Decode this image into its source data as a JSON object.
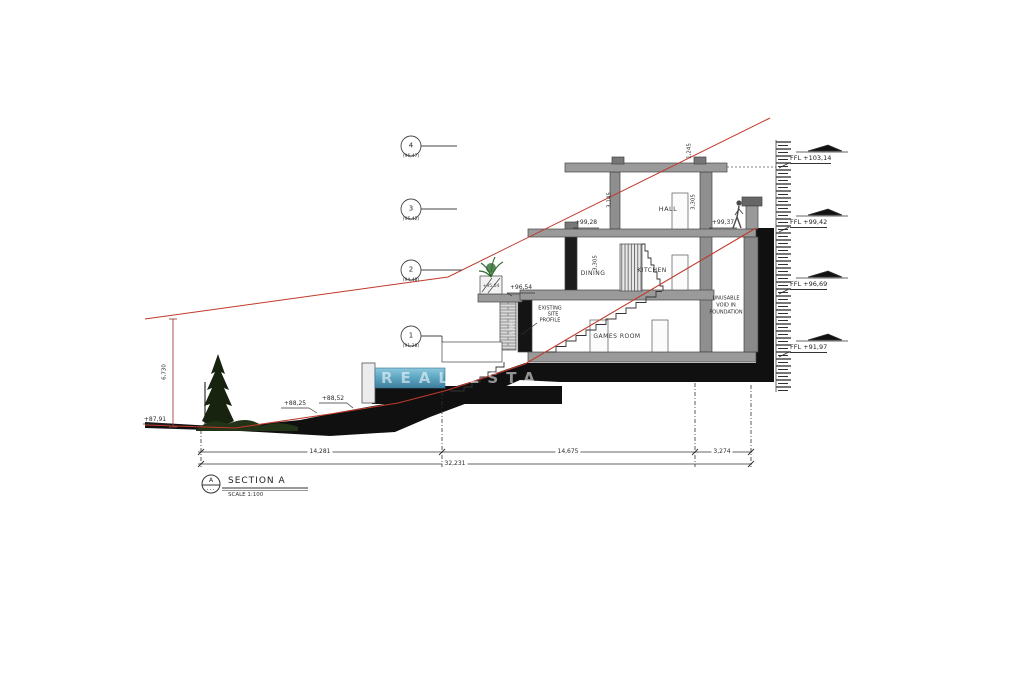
{
  "title": {
    "bubble": "A",
    "dots": "...",
    "name": "SECTION A",
    "scale": "SCALE 1:100"
  },
  "grid_bubbles": [
    {
      "num": "4",
      "level": "(96,47)"
    },
    {
      "num": "3",
      "level": "(95,42)"
    },
    {
      "num": "2",
      "level": "(94,48)"
    },
    {
      "num": "1",
      "level": "(91,28)"
    }
  ],
  "ffl_marks": [
    {
      "label": "FFL +103,14"
    },
    {
      "label": "FFL +99,42"
    },
    {
      "label": "FFL +96,69"
    },
    {
      "label": "FFL +91,97"
    }
  ],
  "rooms": {
    "hall": "HALL",
    "dining": "DINING",
    "kitchen": "KITCHEN",
    "games": "GAMES ROOM",
    "void": [
      "UNUSABLE",
      "VOID IN",
      "FOUNDATION"
    ]
  },
  "levels": {
    "dining_roof": "+99,28",
    "terrace_right": "+99,37",
    "terrace_pool": "+96,54",
    "planter": "+95,04",
    "ground_left": "+87,91",
    "slope_a": "+88,25",
    "slope_b": "+88,52"
  },
  "dims": {
    "left_height": "6,730",
    "hall_left": "3,145",
    "hall_right": "3,305",
    "dining": "3,305",
    "pier": "3,335",
    "roof_top": "1,245",
    "seg1": "14,281",
    "seg2": "14,675",
    "seg3": "3,274",
    "total": "32,231"
  },
  "notes": {
    "existing_profile": [
      "EXISTING",
      "SITE",
      "PROFILE"
    ]
  },
  "watermark": "REAL ESTA",
  "colors": {
    "red_profile": "#c0392b",
    "water": "#5fa8c4",
    "plant": "#2e6b2f"
  }
}
